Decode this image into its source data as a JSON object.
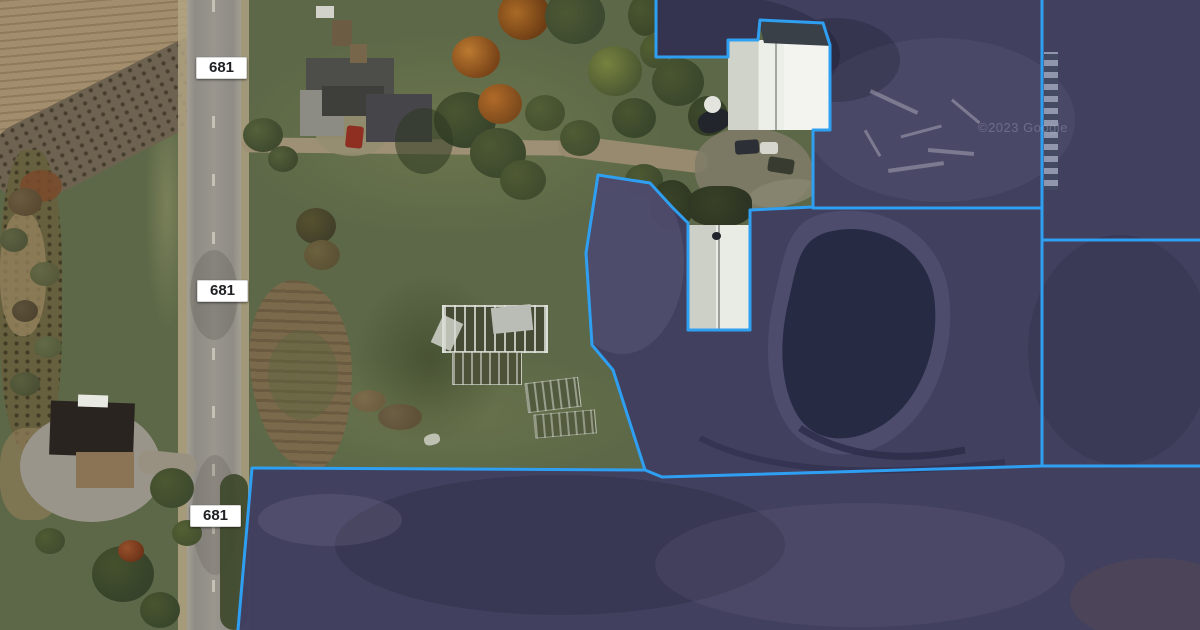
{
  "map": {
    "title": "Aerial parcel map with highlighted parcels",
    "road_labels": [
      "681",
      "681",
      "681"
    ],
    "watermark": "©2023 Google",
    "colors": {
      "parcel_fill": "#413e60",
      "parcel_outline": "#2f9ff2",
      "pond": "#262a43",
      "pond_bank": "#5a5679",
      "grass": "#5c6847",
      "plowed_field": "#a28e6c",
      "road": "#96928a"
    },
    "parcels": {
      "union_path": "M656,0 L1200,0 L1200,630 L238,630 L252,468 L645,470 L613,370 L592,345 L586,253 L598,175 L650,183 L672,207 L688,223 L688,330 L750,330 L750,210 L813,207 L813,130 L830,130 L830,45 L823,23 L760,20 L758,40 L728,40 L728,57 L656,57 Z",
      "outline_path": "M656,0 L656,57 L728,57 L728,40 L758,40 L760,20 L823,23 L830,45 L830,130 L813,130 L813,207 L750,210 L750,330 L688,330 L688,223 L672,207 L650,183 L598,175 L586,253 L592,345 L613,370 L645,470 L252,468 L238,630",
      "inner_lines": [
        "M813,208 L1042,208",
        "M1042,0 L1042,466",
        "M1042,240 L1200,240",
        "M1042,466 L1200,466",
        "M645,470 L662,477 L1042,466"
      ]
    },
    "pond": {
      "path": "M828,232 C872,220 926,244 934,296 C941,348 920,402 881,426 C846,447 810,441 795,411 C781,384 778,344 789,299 C797,264 799,240 828,232 Z",
      "bank_path": "M821,214 C877,200 941,230 949,295 C956,356 932,416 886,443 C846,466 798,453 781,415 C766,384 764,339 775,294 C784,257 787,223 821,214 Z"
    }
  }
}
